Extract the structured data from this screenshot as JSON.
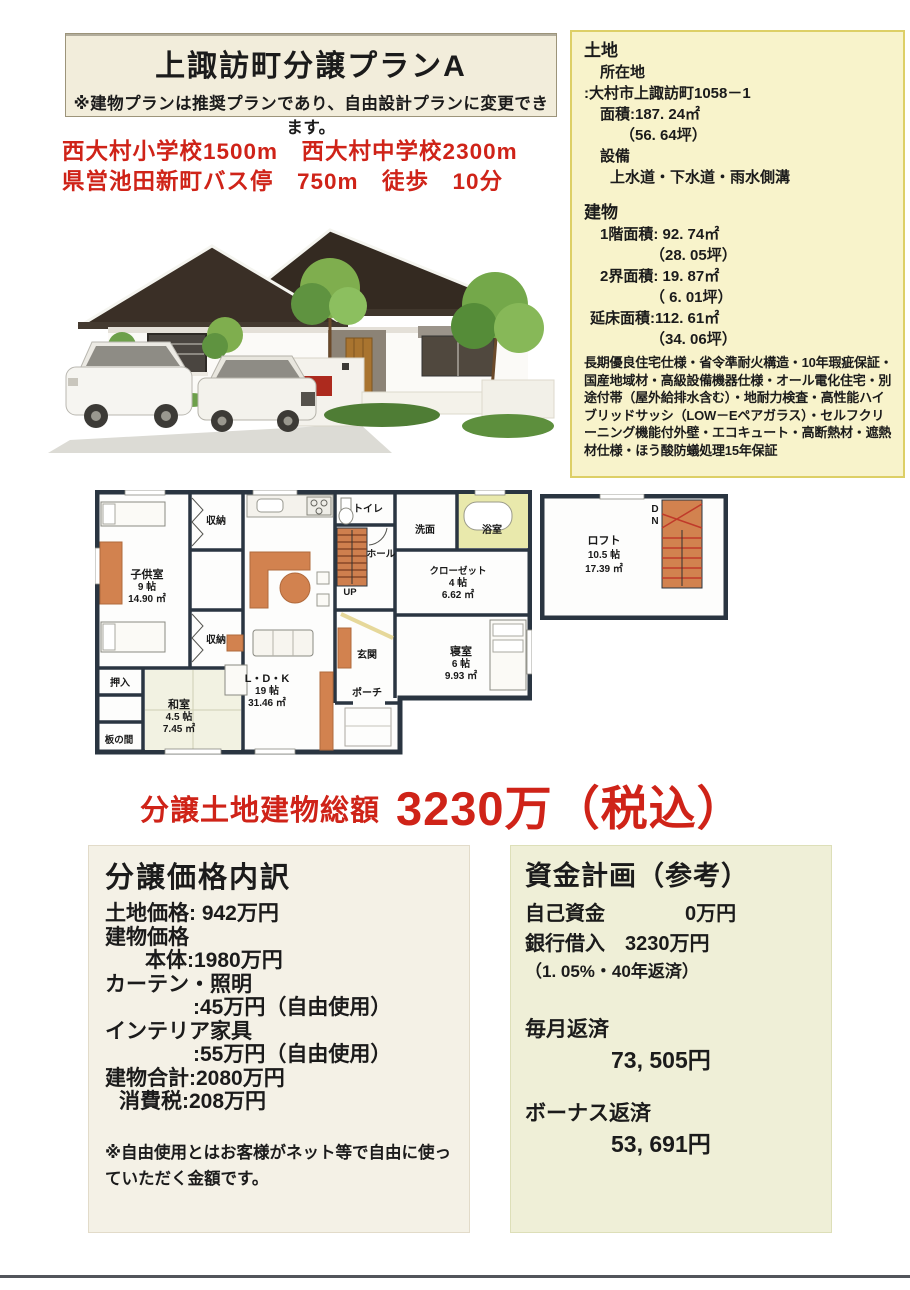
{
  "header": {
    "title": "上諏訪町分譲プランA",
    "note": "※建物プランは推奨プランであり、自由設計プランに変更できます。",
    "access_line1": "西大村小学校1500m　西大村中学校2300m",
    "access_line2": "県営池田新町バス停　750m　徒歩　10分"
  },
  "land": {
    "title": "土地",
    "location_label": "所在地",
    "location_value": ":大村市上諏訪町1058－1",
    "area": "面積:187. 24㎡",
    "area_tsubo": "（56. 64坪）",
    "equip_label": "設備",
    "equip_value": "上水道・下水道・雨水側溝"
  },
  "building": {
    "title": "建物",
    "f1": "1階面積: 92. 74㎡",
    "f1_tsubo": "（28. 05坪）",
    "f2": "2界面積: 19. 87㎡",
    "f2_tsubo": "（ 6. 01坪）",
    "total": "延床面積:112. 61㎡",
    "total_tsubo": "（34. 06坪）",
    "spec": "長期優良住宅仕様・省令準耐火構造・10年瑕疵保証・国産地域材・高級設備機器仕様・オール電化住宅・別途付帯（屋外給排水含む）・地耐力検査・高性能ハイブリッドサッシ（LOW－Eペアガラス）・セルフクリーニング機能付外壁・エコキュート・高断熱材・遮熱材仕様・ほう酸防蟻処理15年保証"
  },
  "floorplan": {
    "rooms": {
      "kodomo": {
        "name": "子供室",
        "size": "9 帖",
        "area": "14.90 ㎡"
      },
      "shuno_top": "収納",
      "shuno_btm": "収納",
      "oshiire": "押入",
      "washitsu": {
        "name": "和室",
        "size": "4.5 帖",
        "area": "7.45 ㎡"
      },
      "itanoma": "板の間",
      "ldk": {
        "name": "L・D・K",
        "size": "19 帖",
        "area": "31.46 ㎡"
      },
      "toilet": "トイレ",
      "hall": "ホール",
      "up": "UP",
      "senmen": "洗面",
      "bath": "浴室",
      "closet": {
        "name": "クローゼット",
        "size": "4 帖",
        "area": "6.62 ㎡"
      },
      "genkan": "玄関",
      "porch": "ポーチ",
      "bedroom": {
        "name": "寝室",
        "size": "6 帖",
        "area": "9.93 ㎡"
      }
    },
    "loft": {
      "name": "ロフト",
      "size": "10.5 帖",
      "area": "17.39 ㎡",
      "dn_d": "D",
      "dn_n": "N"
    }
  },
  "price": {
    "total_label": "分譲土地建物総額",
    "total_value": "3230万（税込）"
  },
  "breakdown": {
    "title": "分譲価格内訳",
    "lines": [
      "土地価格:  942万円",
      "建物価格",
      "本体:1980万円",
      "カーテン・照明",
      ":45万円（自由使用）",
      "インテリア家具",
      ":55万円（自由使用）",
      "建物合計:2080万円",
      "消費税:208万円"
    ],
    "note": "※自由使用とはお客様がネット等で自由に使っていただく金額です。"
  },
  "funding": {
    "title": "資金計画（参考）",
    "row_self": "自己資金　　　　0万円",
    "row_loan": "銀行借入　3230万円",
    "row_terms": "（1. 05%・40年返済）",
    "monthly_label": "毎月返済",
    "monthly_value": "73, 505円",
    "bonus_label": "ボーナス返済",
    "bonus_value": "53, 691円"
  },
  "colors": {
    "accent_red": "#cf2318",
    "plan_wall": "#2a3541",
    "plan_furniture": "#d2824f",
    "plan_bath": "#e9e9ac",
    "box_yellow": "#f8f3cb",
    "box_cream": "#f4f1e6",
    "box_green": "#efefd7"
  }
}
